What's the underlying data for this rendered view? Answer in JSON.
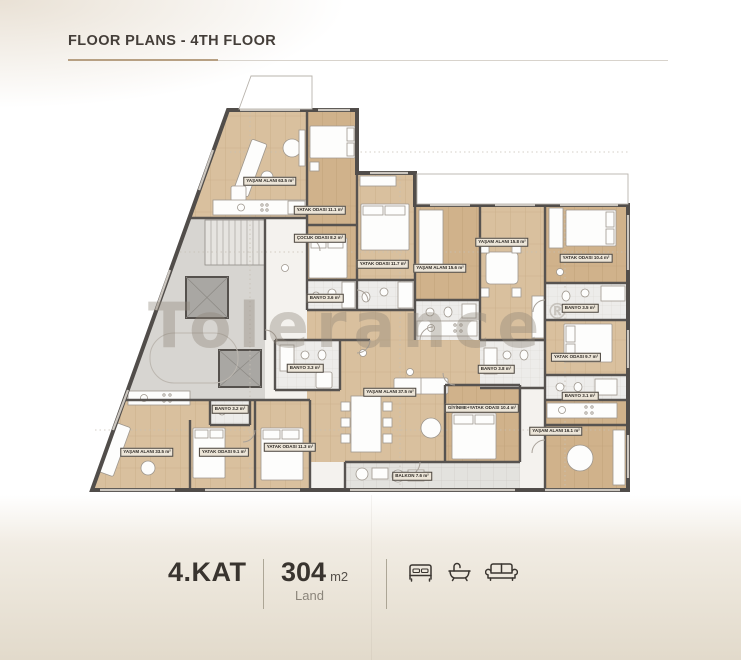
{
  "header": {
    "title": "FLOOR PLANS - 4TH FLOOR"
  },
  "plan": {
    "watermark": "Tolerance",
    "watermark_symbol": "®",
    "labels": [
      {
        "text": "YAŞAM ALANI  63.5 m²"
      },
      {
        "text": "YATAK ODASI  11.1 m²"
      },
      {
        "text": "ÇOCUK ODASI  8.2 m²"
      },
      {
        "text": "YATAK ODASI  11.7 m²"
      },
      {
        "text": "YAŞAM ALANI  15.6 m²"
      },
      {
        "text": "BANYO  3.6 m²"
      },
      {
        "text": "YAŞAM ALANI  15.8 m²"
      },
      {
        "text": "YATAK ODASI  10.4 m²"
      },
      {
        "text": "BANYO  3.5 m²"
      },
      {
        "text": "YATAK ODASI  9.7 m²"
      },
      {
        "text": "BANYO  3.1 m²"
      },
      {
        "text": "YAŞAM ALANI  37.5 m²"
      },
      {
        "text": "GİYİNME+YATAK ODASI  10.4 m²"
      },
      {
        "text": "BANYO  3.8 m²"
      },
      {
        "text": "BANYO  3.3 m²"
      },
      {
        "text": "BANYO  3.2 m²"
      },
      {
        "text": "YAŞAM ALANI  33.5 m²"
      },
      {
        "text": "YATAK ODASI  9.1 m²"
      },
      {
        "text": "YATAK ODASI  11.3 m²"
      },
      {
        "text": "BALKON  7.6 m²"
      },
      {
        "text": "YAŞAM ALANI  16.1 m²"
      }
    ]
  },
  "footer": {
    "floor_label": "4.KAT",
    "area_value": "304",
    "area_unit": "m2",
    "area_caption": "Land",
    "amenity_icons": [
      "bed-icon",
      "bathtub-icon",
      "sofa-icon"
    ]
  }
}
